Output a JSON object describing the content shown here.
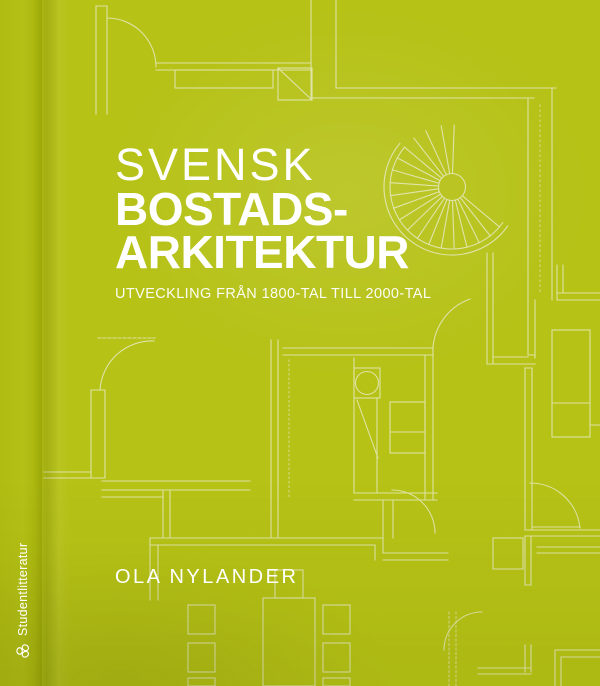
{
  "cover": {
    "title_line1": "SVENSK",
    "title_line2": "BOSTADS-",
    "title_line3": "ARKITEKTUR",
    "subtitle": "UTVECKLING FRÅN 1800-TAL TILL 2000-TAL",
    "author": "OLA NYLANDER"
  },
  "spine": {
    "publisher": "Studentlitteratur"
  },
  "icons": {
    "publisher_logo": "studentlitteratur-mark",
    "background_art": "architectural-floor-plan-with-spiral-staircase"
  },
  "colors": {
    "cover_green": "#b6c216",
    "spine_green": "#a9b50d",
    "plan_line": "#e9ecc8",
    "text": "#ffffff"
  }
}
